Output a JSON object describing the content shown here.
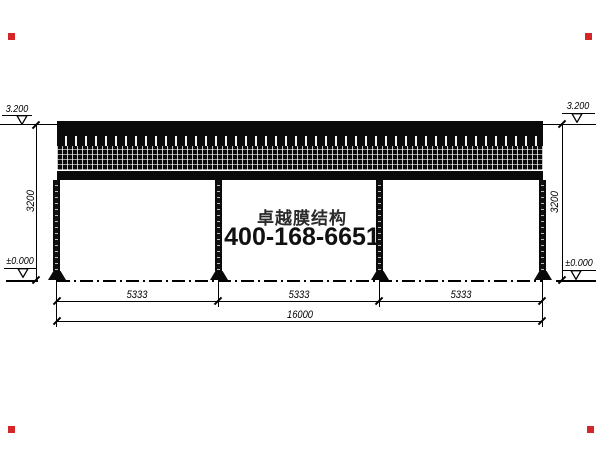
{
  "drawing": {
    "title_watermark": {
      "company": "卓越膜结构",
      "phone": "400-168-6651"
    },
    "levels": {
      "roof": "3.200",
      "ground": "±0.000"
    },
    "dimensions": {
      "span1": "5333",
      "span2": "5333",
      "span3": "5333",
      "total": "16000",
      "height_left": "3200",
      "height_right": "3200"
    },
    "colors": {
      "line": "#000000",
      "structure": "#0a0a0a",
      "corner_marker": "#d42626"
    }
  }
}
